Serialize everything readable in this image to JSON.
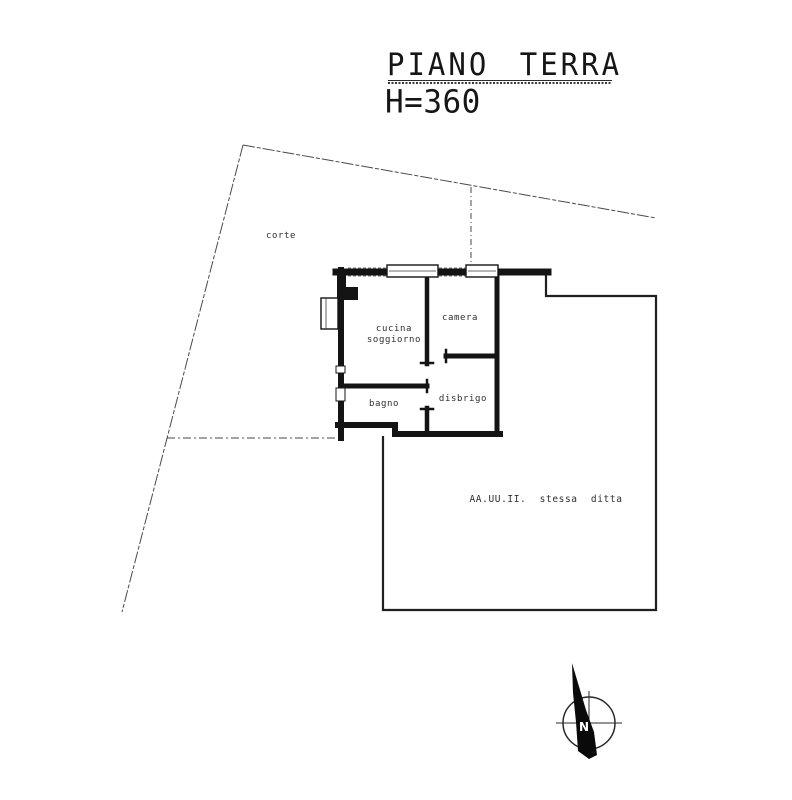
{
  "page": {
    "title_line1": "PIANO TERRA",
    "title_line2": "H=360"
  },
  "plan": {
    "rooms": {
      "corte": "corte",
      "cucina_line1": "cucina",
      "cucina_line2": "soggiorno",
      "camera": "camera",
      "bagno": "bagno",
      "disbrigo": "disbrigo"
    },
    "annotations": {
      "adjacent_units": "AA.UU.II. stessa ditta"
    }
  },
  "compass": {
    "north": "N"
  },
  "colors": {
    "paper": "#ffffff",
    "wall_ink": "#141414",
    "thin_line": "#4a4a4a",
    "text_ink": "#2e2e2e"
  }
}
